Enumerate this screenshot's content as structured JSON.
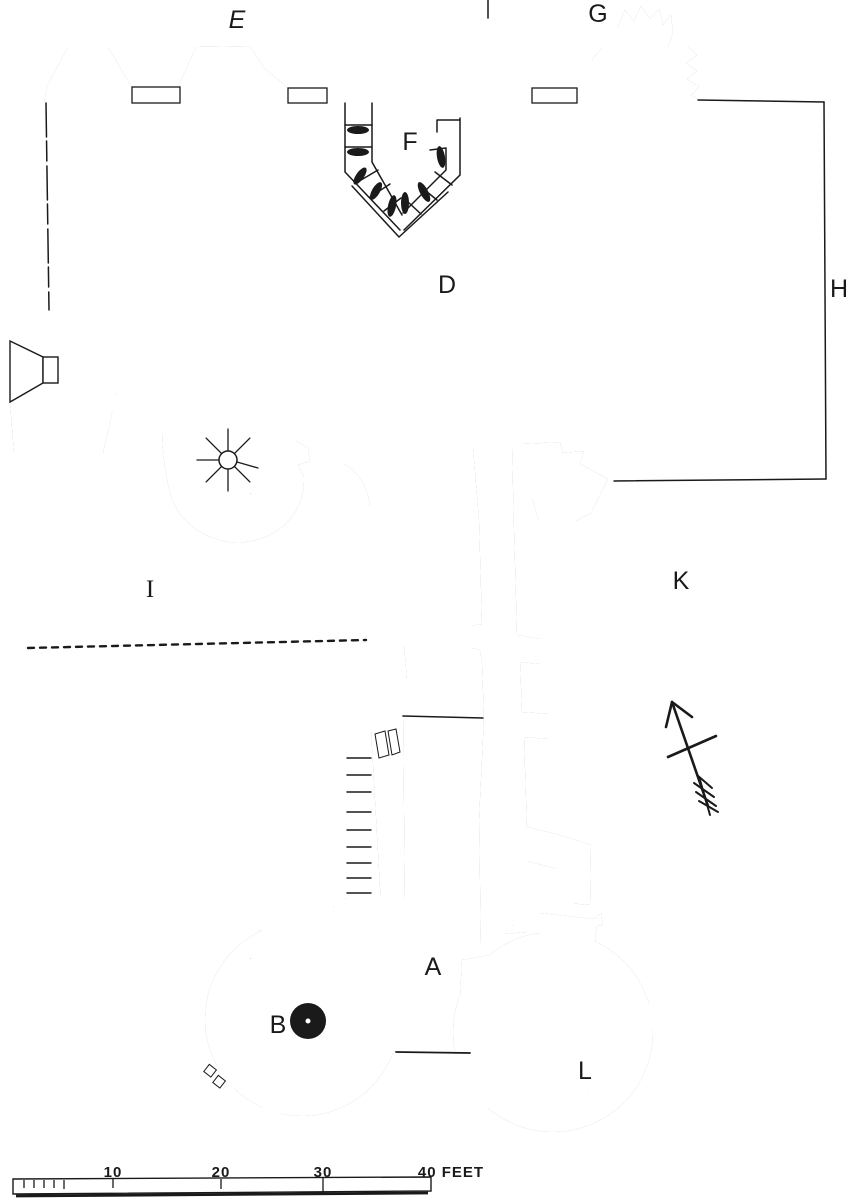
{
  "plan": {
    "description": "Ground floor plan of a ruined castle gatehouse and courtyard (engraved survey drawing)",
    "labels": {
      "A": "A",
      "B": "B",
      "D": "D",
      "E": "E",
      "F": "F",
      "G": "G",
      "H": "H",
      "I": "I",
      "K": "K",
      "L": "L"
    }
  },
  "scale_bar": {
    "tick_10": "10",
    "tick_20": "20",
    "tick_30": "30",
    "end": "40 FEET"
  },
  "colors": {
    "ink": "#1a1a1a",
    "paper": "#ffffff"
  }
}
